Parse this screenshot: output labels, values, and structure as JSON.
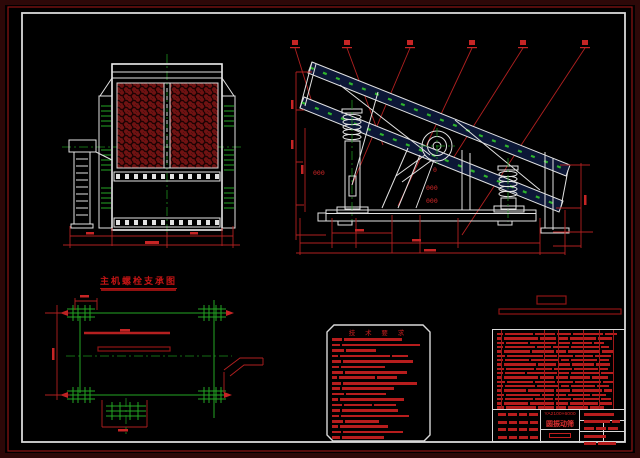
{
  "drawing": {
    "type": "CAD engineering drawing, black background",
    "views": [
      "front-view",
      "side-view",
      "plan-view",
      "technical-notes",
      "parts-list-title-block"
    ]
  },
  "colors": {
    "background": "#000000",
    "line_white": "#e2e2e2",
    "cad_green": "#23a623",
    "cad_red": "#b12020",
    "mesh_red": "#701212",
    "deck_navy": "#0c1736",
    "border_maroon": "#2d0808",
    "border_red": "#9e1414"
  },
  "captions": {
    "plan_view_title": "主机螺栓支承图",
    "tech_requirements_title": "技 术 要 求",
    "model": "YA2100×6000",
    "drawing_name": "圆振动筛"
  },
  "side_view_labels": {
    "dim_a": "000",
    "dim_b": "0",
    "dim_c": "000",
    "dim_d": "000"
  },
  "bars": {
    "tech": {
      "pitch": 5.45,
      "barH": 2.6,
      "rows": [
        [
          10,
          58
        ],
        [
          8,
          78
        ],
        [
          12,
          30
        ],
        [
          6,
          50,
          16
        ],
        [
          9,
          70
        ],
        [
          7,
          44
        ],
        [
          11,
          62
        ],
        [
          5,
          36,
          20
        ],
        [
          9,
          74
        ],
        [
          8,
          52
        ],
        [
          12,
          40
        ],
        [
          6,
          64
        ],
        [
          10,
          28,
          22
        ],
        [
          8,
          56
        ],
        [
          7,
          68
        ],
        [
          11,
          34
        ],
        [
          6,
          48
        ],
        [
          9,
          60
        ],
        [
          8,
          42
        ]
      ]
    },
    "bom": {
      "pitch": 4.33,
      "barH": 2.5,
      "rows": [
        [
          6,
          28,
          20,
          14,
          30,
          12
        ],
        [
          5,
          34,
          16,
          10,
          26,
          14
        ],
        [
          7,
          22,
          26,
          12,
          20,
          10
        ],
        [
          6,
          30,
          14,
          16,
          28,
          8
        ],
        [
          5,
          26,
          22,
          10,
          32,
          12
        ],
        [
          8,
          36,
          12,
          14,
          18,
          16
        ],
        [
          6,
          24,
          28,
          8,
          26,
          10
        ],
        [
          5,
          32,
          18,
          12,
          22,
          14
        ],
        [
          7,
          28,
          16,
          18,
          24,
          8
        ],
        [
          6,
          20,
          30,
          10,
          28,
          12
        ],
        [
          5,
          34,
          14,
          12,
          20,
          16
        ],
        [
          8,
          26,
          20,
          16,
          26,
          10
        ],
        [
          6,
          30,
          22,
          8,
          24,
          12
        ],
        [
          5,
          22,
          26,
          14,
          30,
          8
        ],
        [
          7,
          34,
          12,
          10,
          22,
          14
        ],
        [
          6,
          28,
          18,
          16,
          26,
          10
        ],
        [
          5,
          24,
          24,
          12,
          28,
          12
        ],
        [
          7,
          30,
          16,
          10,
          20,
          14
        ]
      ]
    },
    "tb_left": {
      "pitch": 7.6,
      "barH": 3,
      "rows": [
        [
          8,
          9,
          8,
          9
        ],
        [
          9,
          8,
          9,
          8
        ],
        [
          8,
          9,
          8,
          9
        ],
        [
          9,
          8,
          9,
          8
        ]
      ]
    },
    "tb_right": {
      "pitch": 7.2,
      "barH": 3,
      "rows": [
        [
          30
        ],
        [
          26,
          8
        ],
        [
          10,
          10,
          10
        ],
        [
          22
        ],
        [
          12,
          18
        ]
      ]
    }
  }
}
